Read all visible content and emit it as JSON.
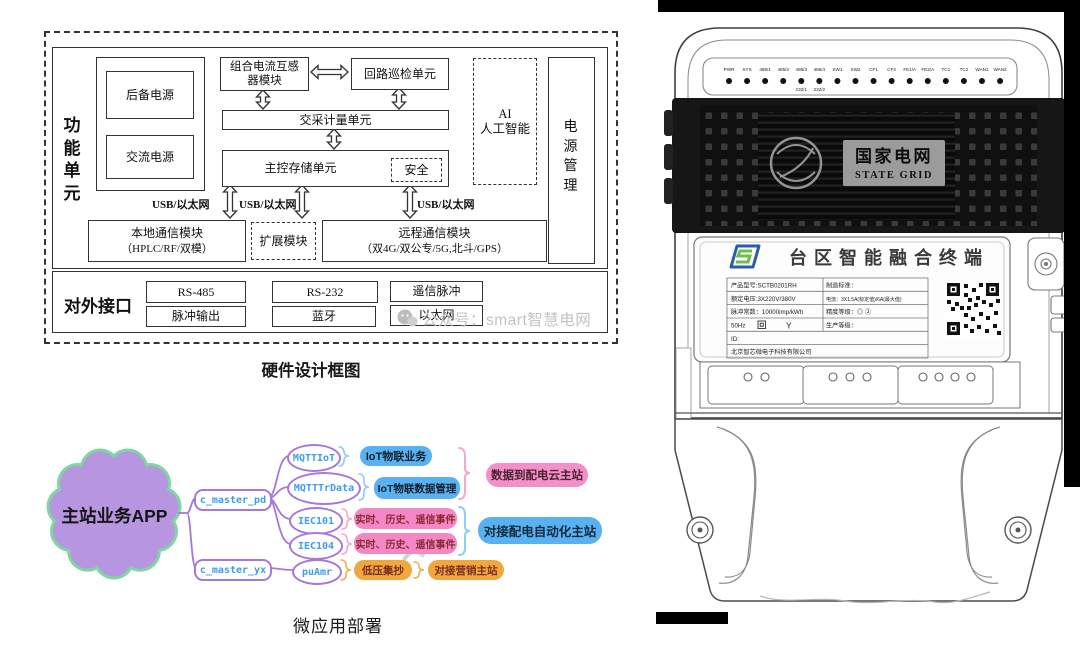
{
  "hw": {
    "caption": "硬件设计框图",
    "func_unit": "功能单元",
    "ext_if": "对外接口",
    "backup": "后备电源",
    "ac": "交流电源",
    "ct1": "组合电流互感",
    "ct2": "器模块",
    "loop": "回路巡检单元",
    "meter": "交采计量单元",
    "main": "主控存储单元",
    "sec": "安全",
    "ai1": "AI",
    "ai2": "人工智能",
    "pwr_mgmt": "电源管理",
    "usb": "USB/以太网",
    "local1": "本地通信模块",
    "local2": "（HPLC/RF/双模）",
    "exp": "扩展模块",
    "remote1": "远程通信模块",
    "remote2": "（双4G/双公专/5G,北斗/GPS）",
    "if_rs485": "RS-485",
    "if_rs232": "RS-232",
    "if_yx": "遥信脉冲",
    "if_pulse": "脉冲输出",
    "if_bt": "蓝牙",
    "if_eth": "以太网"
  },
  "watermark": "公众号：smart智慧电网",
  "mindmap": {
    "caption": "微应用部署",
    "root": "主站业务APP",
    "b1": "c_master_pd",
    "b2": "c_master_yx",
    "n1": "MQTTIoT",
    "n2": "MQTTTrData",
    "n3": "IEC101",
    "n4": "IEC104",
    "n5": "puAmr",
    "l1": "IoT物联业务",
    "l2": "IoT物联数据管理",
    "l3": "实时、历史、遥信事件",
    "l4": "实时、历史、遥信事件",
    "l5": "低压集抄",
    "l6": "对接营销主站",
    "g1": "数据到配电云主站",
    "g2": "对接配电自动化主站"
  },
  "device": {
    "leds": [
      "PWR",
      "SYS",
      "485/1",
      "485/2",
      "485/3",
      "485/4",
      "SW1",
      "SW2",
      "CF1",
      "CF2",
      "FE1/A",
      "FE2/A",
      "TC1",
      "TC2",
      "WAN1",
      "WAN2"
    ],
    "led_sub": [
      "232/1",
      "232/2"
    ],
    "brand_cn": "国家电网",
    "brand_en": "STATE GRID",
    "title": "台区智能融合终端",
    "rows": [
      {
        "l": "产品型号:SCTB0201RH",
        "r": "制造标准："
      },
      {
        "l": "额定电压:3X220V/380V",
        "r": "电流：3X1.5A(标定值)/6A(最大值)"
      },
      {
        "l": "脉冲常数：10000imp/kWh",
        "r": "精度等级：◎ ②"
      },
      {
        "l": "50Hz",
        "r": "生产等级："
      },
      {
        "l": "ID:",
        "r": ""
      },
      {
        "l": "北京智芯微电子科技有限公司",
        "r": ""
      }
    ],
    "sym_y": "Y"
  },
  "colors": {
    "purple": "#a678d8",
    "cloud_fill": "#b795e0",
    "cloud_border": "#7fd79f",
    "blue_fill": "#58b2f1",
    "pink_fill": "#f488c6",
    "orange_fill": "#f0a83e",
    "node_text": "#3f9bef"
  }
}
